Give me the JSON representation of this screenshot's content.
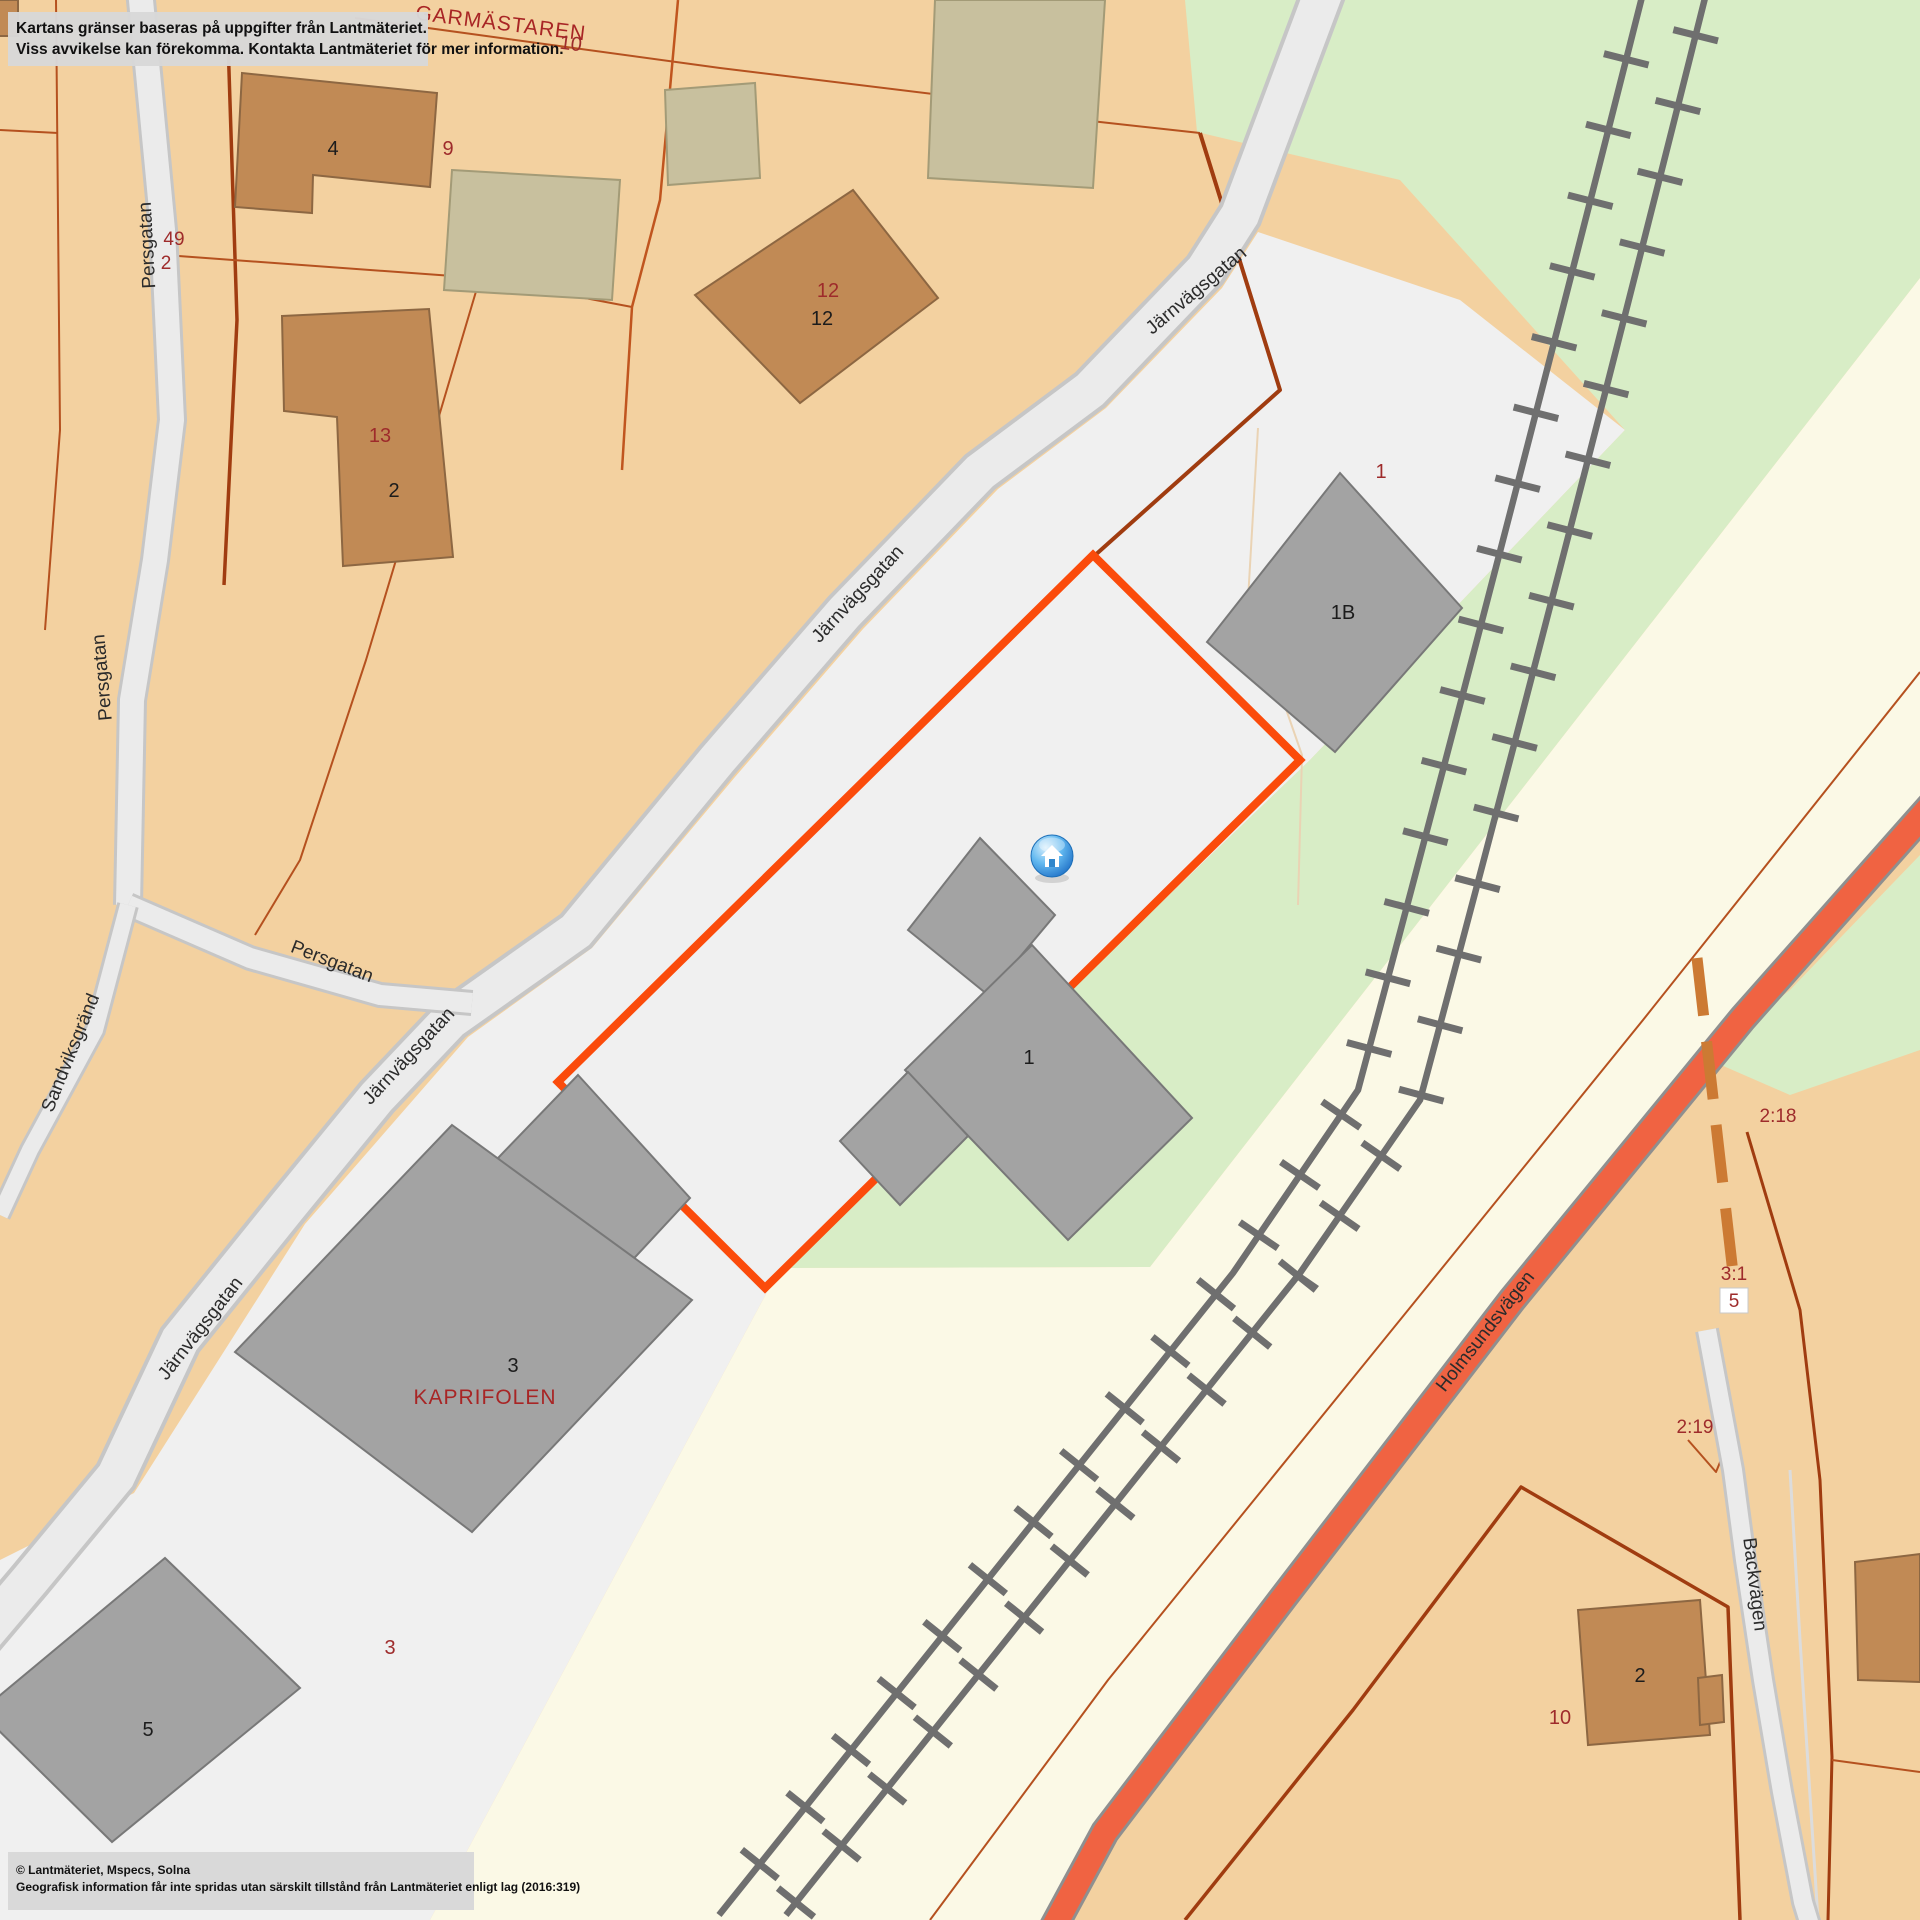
{
  "map": {
    "type": "cadastral-map",
    "provider_note": "Lantmäteriet parcel map"
  },
  "disclaimer": {
    "line1": "Kartans gränser baseras på uppgifter från Lantmäteriet.",
    "line2": "Viss avvikelse kan förekomma. Kontakta Lantmäteriet för mer information."
  },
  "copyright": {
    "line1": "© Lantmäteriet, Mspecs, Solna",
    "line2": "Geografisk information får inte spridas utan särskilt tillstånd från Lantmäteriet enligt lag (2016:319)"
  },
  "streets": {
    "jarnvagsgatan": "Järnvägsgatan",
    "persgatan": "Persgatan",
    "sandviksgrand": "Sandviksgränd",
    "holmsundsvagen": "Holmsundsvägen",
    "backvagen": "Backvägen"
  },
  "blocks": {
    "garmastaren": "GARMÄSTAREN",
    "garmastaren_num": "10",
    "kaprifolen": "KAPRIFOLEN"
  },
  "parcels": {
    "p9": "9",
    "p49": "49",
    "p2a": "2",
    "p13": "13",
    "p12": "12",
    "p1": "1",
    "p3": "3",
    "p218": "2:18",
    "p31": "3:1",
    "p31_shield": "5",
    "p219": "2:19",
    "p10": "10"
  },
  "buildings": {
    "b4": "4",
    "b13_2": "2",
    "b12": "12",
    "b1b": "1B",
    "b1": "1",
    "b3": "3",
    "b5": "5",
    "b2se": "2"
  },
  "marker": {
    "label": "home-marker"
  },
  "colors": {
    "land": "#f3d1a0",
    "parcel_light": "#f0f0f0",
    "green": "#d8edc6",
    "railway_corridor": "#fbf9e6",
    "road_fill": "#ebebeb",
    "road_casing": "#c6c6c6",
    "orange_road": "#f06342",
    "highlight": "#fb4b0b",
    "boundary_thin": "#b5511f",
    "boundary_thick": "#a03c10",
    "dashed_boundary": "#cc7a33",
    "building_brown": "#c18a55",
    "building_olive": "#c8c09e",
    "building_gray": "#a3a3a3",
    "railway": "#6f6f6f",
    "red_text": "#9e2b2b",
    "marker_blue": "#1565c0"
  }
}
